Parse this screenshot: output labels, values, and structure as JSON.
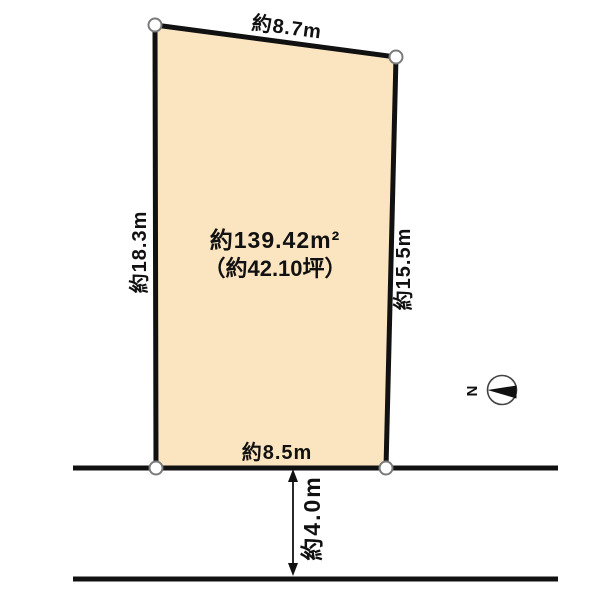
{
  "plot": {
    "fill_color": "#FBE4C0",
    "outline_color": "#111111",
    "area_line1": "約139.42m²",
    "area_line2": "（約42.10坪）",
    "dimensions": {
      "top": "約8.7m",
      "left": "約18.3m",
      "right": "約15.5m",
      "bottom": "約8.5m"
    }
  },
  "road": {
    "width_label": "約4.0m"
  },
  "compass": {
    "north_label": "N"
  }
}
